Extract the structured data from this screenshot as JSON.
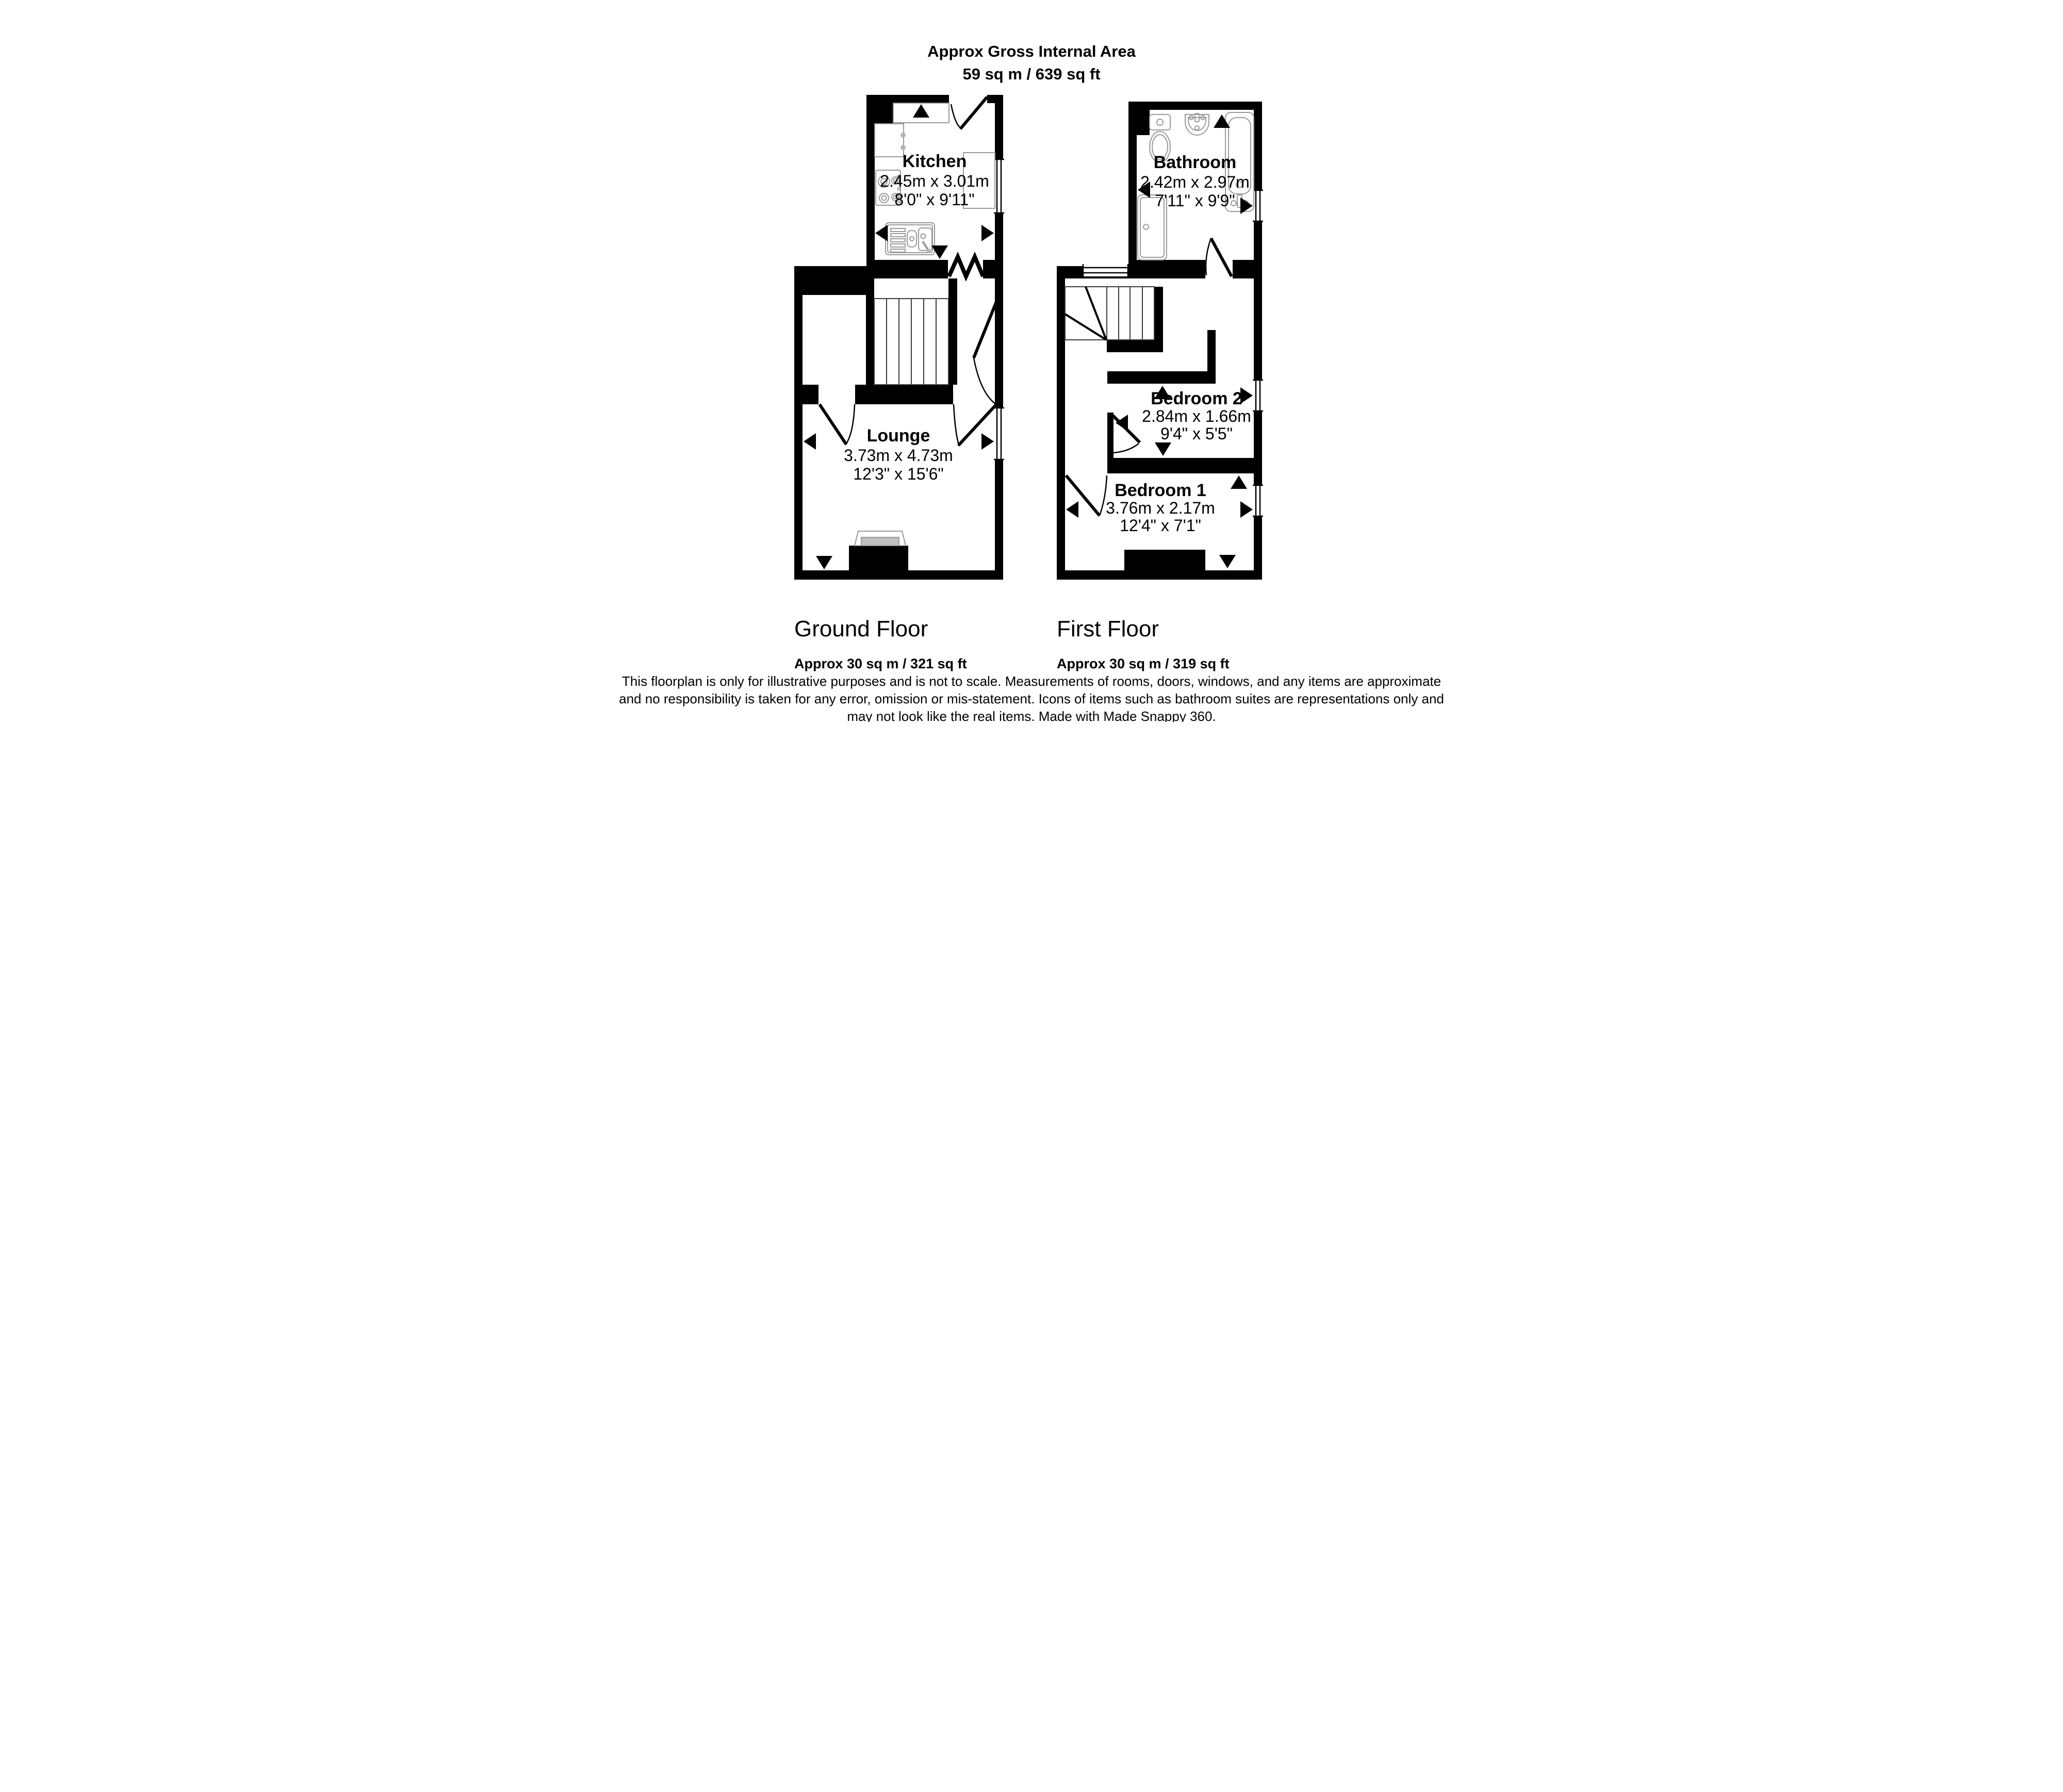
{
  "header": {
    "title": "Approx Gross Internal Area",
    "area": "59 sq m / 639 sq ft"
  },
  "rooms": {
    "kitchen": {
      "name": "Kitchen",
      "metric": "2.45m x 3.01m",
      "imperial": "8'0\" x 9'11\""
    },
    "bathroom": {
      "name": "Bathroom",
      "metric": "2.42m x 2.97m",
      "imperial": "7'11\" x 9'9\""
    },
    "lounge": {
      "name": "Lounge",
      "metric": "3.73m x 4.73m",
      "imperial": "12'3\" x 15'6\""
    },
    "bedroom2": {
      "name": "Bedroom 2",
      "metric": "2.84m x 1.66m",
      "imperial": "9'4\" x 5'5\""
    },
    "bedroom1": {
      "name": "Bedroom 1",
      "metric": "3.76m x 2.17m",
      "imperial": "12'4\" x 7'1\""
    }
  },
  "floors": {
    "ground": {
      "label": "Ground Floor",
      "area": "Approx 30 sq m / 321 sq ft"
    },
    "first": {
      "label": "First Floor",
      "area": "Approx 30 sq m / 319 sq ft"
    }
  },
  "disclaimer": {
    "line1": "This floorplan is only for illustrative purposes and is not to scale. Measurements of rooms, doors, windows, and any items are approximate",
    "line2": "and no responsibility is taken for any error, omission or mis-statement. Icons of items such as bathroom suites are representations only and",
    "line3": "may not look like the real items. Made with Made Snappy 360."
  },
  "colors": {
    "wall": "#000000",
    "fixture_outline": "#9a9a9a",
    "hearth_fill": "#c0c0c0"
  }
}
